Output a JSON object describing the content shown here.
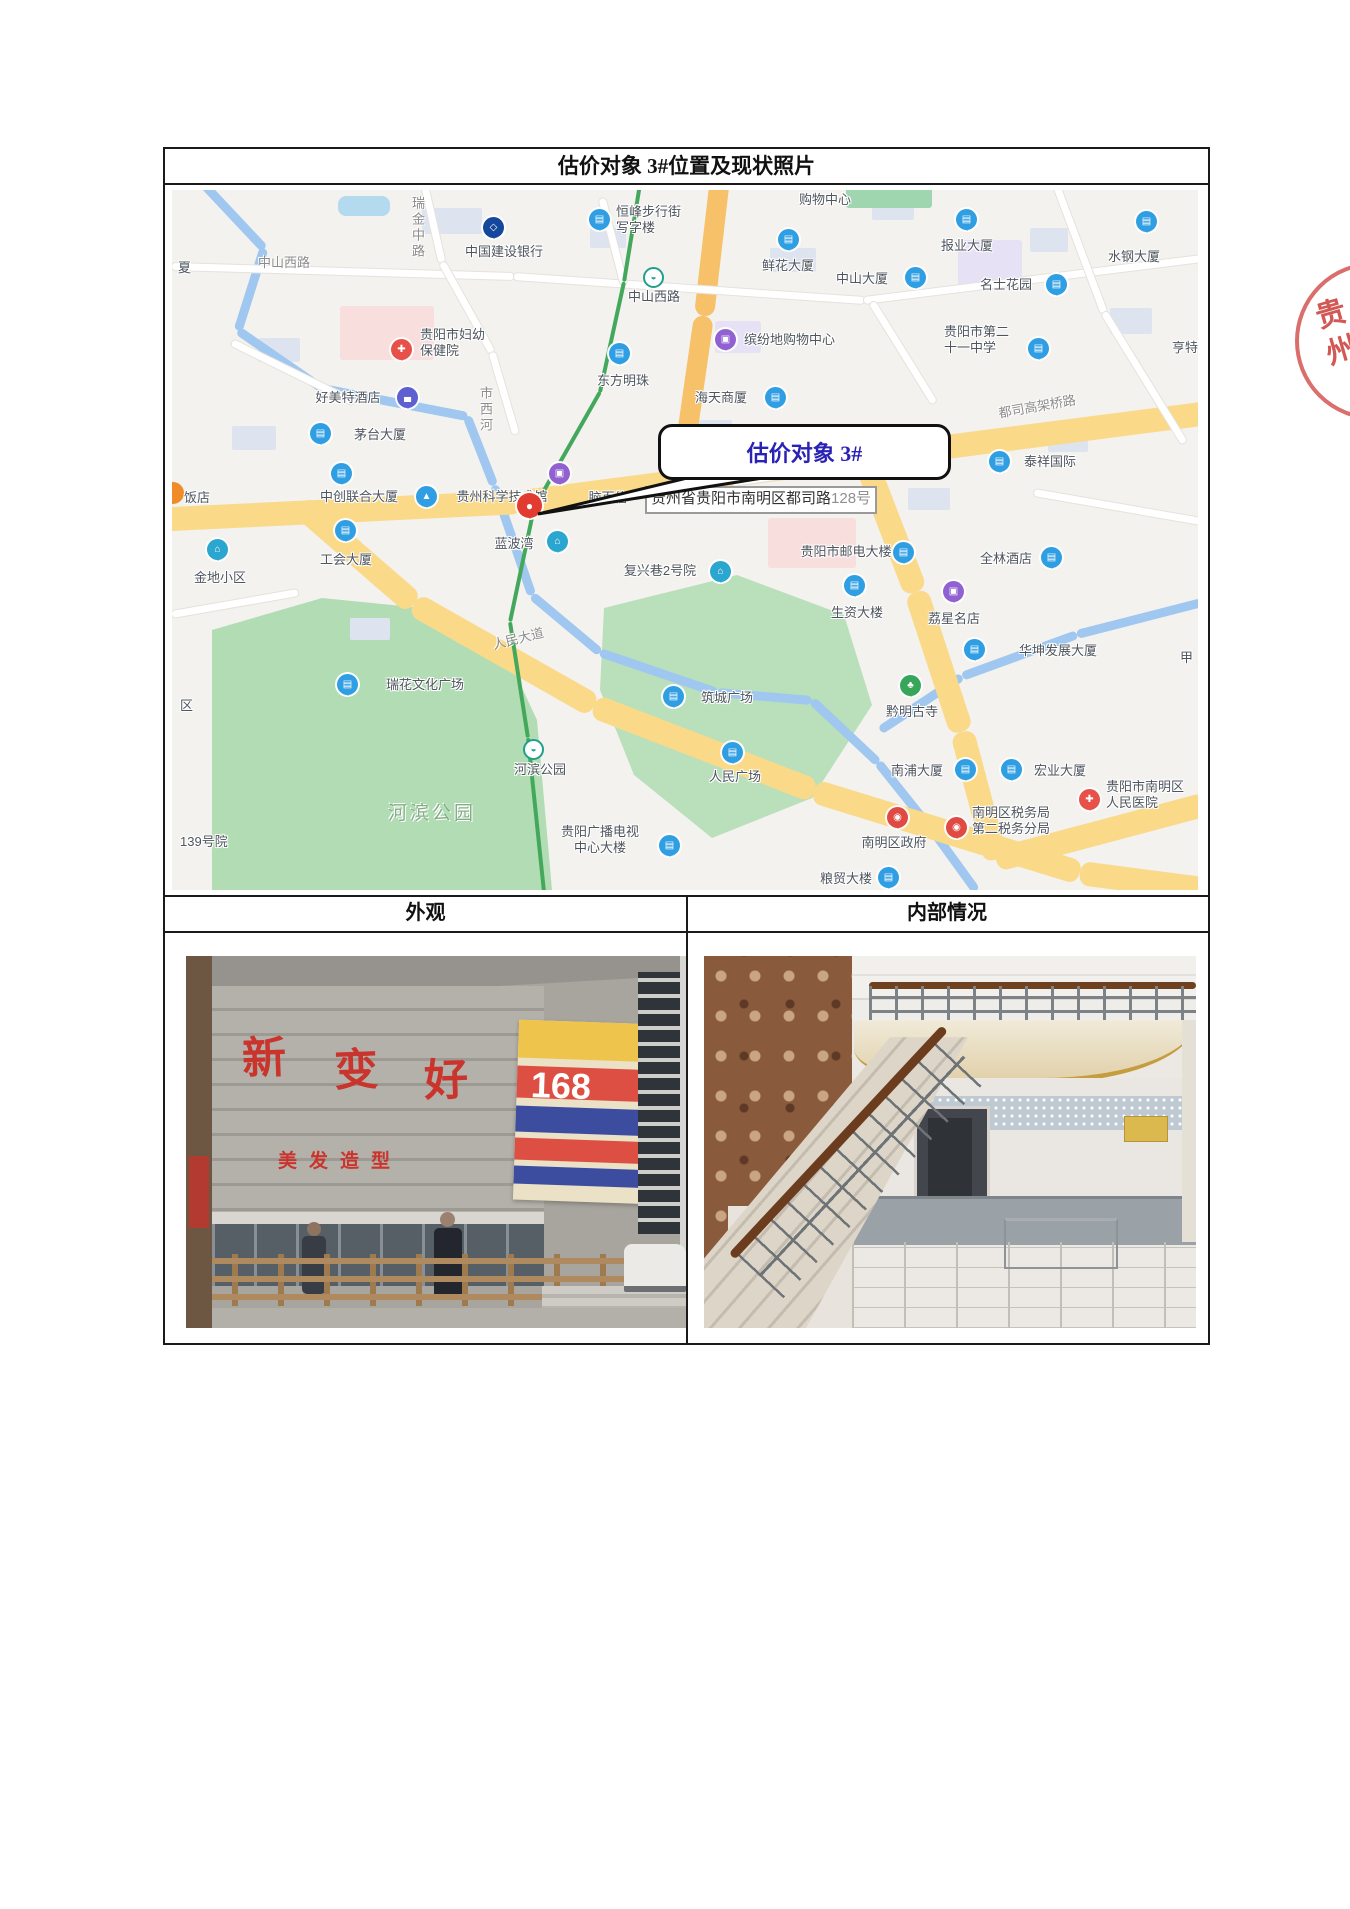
{
  "page": {
    "title": "估价对象 3#位置及现状照片"
  },
  "stamp": {
    "text": "贵州"
  },
  "headers": {
    "left": "外观",
    "right": "内部情况"
  },
  "map": {
    "callout_text": "估价对象 3#",
    "address": {
      "main": "贵州省贵阳市南明区都司路",
      "number": "128号"
    },
    "road_labels": [
      {
        "t": "瑞金中路",
        "x": 236,
        "y": 6,
        "v": true
      },
      {
        "t": "中山西路",
        "x": 86,
        "y": 62
      },
      {
        "t": "市西河",
        "x": 304,
        "y": 196,
        "v": true
      },
      {
        "t": "都司高架桥路",
        "x": 826,
        "y": 206,
        "r": -10
      },
      {
        "t": "人民大道",
        "x": 320,
        "y": 438,
        "r": -14
      },
      {
        "t": "河滨公园",
        "x": 216,
        "y": 608,
        "area": true
      }
    ],
    "pois": [
      {
        "t": [
          "恒峰步行街",
          "写字楼"
        ],
        "px": 428,
        "py": 30,
        "pt": "building",
        "lx": 444,
        "ly": 14,
        "la": "l"
      },
      {
        "t": [
          "购物中心"
        ],
        "lx": 653,
        "ly": 2,
        "la": "c"
      },
      {
        "t": [
          "中国建设银行"
        ],
        "px": 322,
        "py": 38,
        "pt": "bank",
        "lx": 332,
        "ly": 54,
        "la": "c"
      },
      {
        "t": [
          "鲜花大厦"
        ],
        "px": 617,
        "py": 50,
        "pt": "building",
        "lx": 616,
        "ly": 68,
        "la": "c"
      },
      {
        "t": [
          "中山大厦"
        ],
        "px": 744,
        "py": 88,
        "pt": "building",
        "lx": 690,
        "ly": 81,
        "la": "c"
      },
      {
        "t": [
          "报业大厦"
        ],
        "px": 795,
        "py": 30,
        "pt": "building",
        "lx": 795,
        "ly": 48,
        "la": "c"
      },
      {
        "t": [
          "水钢大厦"
        ],
        "px": 975,
        "py": 32,
        "pt": "building",
        "lx": 962,
        "ly": 59,
        "la": "c"
      },
      {
        "t": [
          "名士花园"
        ],
        "px": 885,
        "py": 95,
        "pt": "building",
        "lx": 834,
        "ly": 87,
        "la": "c"
      },
      {
        "t": [
          "缤纷地购物中心"
        ],
        "px": 554,
        "py": 150,
        "pt": "shopping",
        "lx": 572,
        "ly": 142,
        "la": "l"
      },
      {
        "t": [
          "贵阳市第二",
          "十一中学"
        ],
        "px": 867,
        "py": 159,
        "pt": "building",
        "lx": 772,
        "ly": 134,
        "la": "l"
      },
      {
        "t": [
          "亨特"
        ],
        "lx": 1000,
        "ly": 150,
        "la": "l"
      },
      {
        "t": [
          "贵阳市妇幼",
          "保健院"
        ],
        "px": 230,
        "py": 160,
        "pt": "hospital",
        "lx": 248,
        "ly": 137,
        "la": "l"
      },
      {
        "t": [
          "好美特酒店"
        ],
        "px": 236,
        "py": 208,
        "pt": "hotel",
        "lx": 176,
        "ly": 200,
        "la": "c"
      },
      {
        "t": [
          "东方明珠"
        ],
        "px": 448,
        "py": 164,
        "pt": "building",
        "lx": 451,
        "ly": 183,
        "la": "c"
      },
      {
        "t": [
          "海天商厦"
        ],
        "px": 604,
        "py": 208,
        "pt": "building",
        "lx": 549,
        "ly": 200,
        "la": "c"
      },
      {
        "t": [
          "茅台大厦"
        ],
        "px": 149,
        "py": 244,
        "pt": "building",
        "lx": 208,
        "ly": 237,
        "la": "c"
      },
      {
        "t": [
          "泰祥国际"
        ],
        "px": 828,
        "py": 272,
        "pt": "building",
        "lx": 878,
        "ly": 264,
        "la": "c"
      },
      {
        "t": [
          "饭店"
        ],
        "lx": 12,
        "ly": 300,
        "la": "l"
      },
      {
        "t": [
          "中创联合大厦"
        ],
        "px": 170,
        "py": 284,
        "pt": "building",
        "lx": 187,
        "ly": 299,
        "la": "c"
      },
      {
        "t": [
          "贵州科学技术馆"
        ],
        "px": 255,
        "py": 307,
        "pt": "museum",
        "lx": 330,
        "ly": 299,
        "la": "c"
      },
      {
        "t": [
          "脑百信"
        ],
        "lx": 436,
        "ly": 300,
        "la": "c"
      },
      {
        "t": [],
        "px": 388,
        "py": 284,
        "pt": "shopping"
      },
      {
        "t": [],
        "px": 358,
        "py": 316,
        "pt": "target"
      },
      {
        "t": [
          "工会大厦"
        ],
        "px": 174,
        "py": 341,
        "pt": "building",
        "lx": 174,
        "ly": 362,
        "la": "c"
      },
      {
        "t": [
          "金地小区"
        ],
        "px": 46,
        "py": 360,
        "pt": "community",
        "lx": 48,
        "ly": 380,
        "la": "c"
      },
      {
        "t": [
          "蓝波湾"
        ],
        "px": 386,
        "py": 352,
        "pt": "community",
        "lx": 342,
        "ly": 346,
        "la": "c"
      },
      {
        "t": [
          "复兴巷2号院"
        ],
        "px": 549,
        "py": 382,
        "pt": "community",
        "lx": 488,
        "ly": 373,
        "la": "c"
      },
      {
        "t": [
          "贵阳市邮电大楼"
        ],
        "px": 732,
        "py": 363,
        "pt": "building",
        "lx": 674,
        "ly": 354,
        "la": "c"
      },
      {
        "t": [
          "全林酒店"
        ],
        "px": 880,
        "py": 368,
        "pt": "building",
        "lx": 834,
        "ly": 361,
        "la": "c"
      },
      {
        "t": [
          "生资大楼"
        ],
        "px": 683,
        "py": 396,
        "pt": "building",
        "lx": 685,
        "ly": 415,
        "la": "c"
      },
      {
        "t": [
          "荔星名店"
        ],
        "px": 782,
        "py": 402,
        "pt": "shopping",
        "lx": 782,
        "ly": 421,
        "la": "c"
      },
      {
        "t": [
          "华坤发展大厦"
        ],
        "px": 803,
        "py": 460,
        "pt": "building",
        "lx": 886,
        "ly": 453,
        "la": "c"
      },
      {
        "t": [
          "甲"
        ],
        "lx": 1008,
        "ly": 460,
        "la": "l"
      },
      {
        "t": [
          "瑞花文化广场"
        ],
        "px": 176,
        "py": 495,
        "pt": "building",
        "lx": 253,
        "ly": 487,
        "la": "c"
      },
      {
        "t": [
          "筑城广场"
        ],
        "px": 502,
        "py": 507,
        "pt": "building",
        "lx": 555,
        "ly": 500,
        "la": "c"
      },
      {
        "t": [
          "黔明古寺"
        ],
        "px": 739,
        "py": 496,
        "pt": "temple",
        "lx": 740,
        "ly": 514,
        "la": "c"
      },
      {
        "t": [
          "人民广场"
        ],
        "px": 561,
        "py": 563,
        "pt": "building",
        "lx": 563,
        "ly": 579,
        "la": "c"
      },
      {
        "t": [
          "南浦大厦"
        ],
        "px": 794,
        "py": 580,
        "pt": "building",
        "lx": 745,
        "ly": 573,
        "la": "c"
      },
      {
        "t": [
          "宏业大厦"
        ],
        "px": 840,
        "py": 580,
        "pt": "building",
        "lx": 888,
        "ly": 573,
        "la": "c"
      },
      {
        "t": [
          "贵阳市南明区",
          "人民医院"
        ],
        "px": 918,
        "py": 610,
        "pt": "hospital",
        "lx": 934,
        "ly": 589,
        "la": "l"
      },
      {
        "t": [
          "贵阳广播电视",
          "中心大楼"
        ],
        "px": 498,
        "py": 656,
        "pt": "building",
        "lx": 428,
        "ly": 634,
        "la": "c"
      },
      {
        "t": [
          "南明区政府"
        ],
        "px": 726,
        "py": 628,
        "pt": "gov",
        "lx": 722,
        "ly": 645,
        "la": "c"
      },
      {
        "t": [
          "南明区税务局",
          "第二税务分局"
        ],
        "px": 785,
        "py": 638,
        "pt": "gov",
        "lx": 800,
        "ly": 615,
        "la": "l"
      },
      {
        "t": [
          "粮贸大楼"
        ],
        "px": 717,
        "py": 688,
        "pt": "building",
        "lx": 674,
        "ly": 681,
        "la": "c"
      },
      {
        "t": [
          "139号院"
        ],
        "lx": 8,
        "ly": 644,
        "la": "l"
      },
      {
        "t": [
          "夏"
        ],
        "lx": 6,
        "ly": 70,
        "la": "l"
      },
      {
        "t": [
          "区"
        ],
        "lx": 8,
        "ly": 508,
        "la": "l"
      },
      {
        "t": [
          "中山西路"
        ],
        "px": 482,
        "py": 88,
        "pt": "metro",
        "lx": 482,
        "ly": 99,
        "la": "c"
      },
      {
        "t": [
          "河滨公园"
        ],
        "px": 362,
        "py": 560,
        "pt": "metro",
        "lx": 368,
        "ly": 572,
        "la": "c"
      }
    ]
  },
  "photos": {
    "exterior": {
      "chars": [
        "新",
        "变",
        "好"
      ],
      "subtext": "美发造型",
      "sign_number": "168"
    }
  }
}
